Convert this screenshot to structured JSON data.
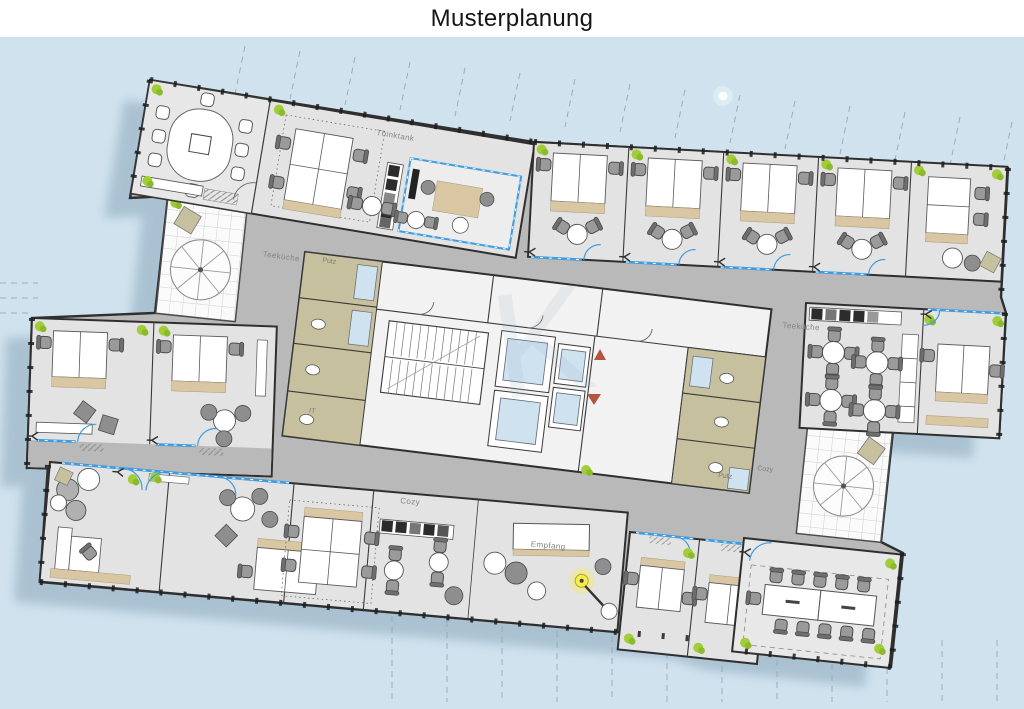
{
  "title": "Musterplanung",
  "labels": {
    "thinktank": "Thinktank",
    "teekueche_left": "Teeküche",
    "putz_left": "Putz",
    "it_room": "IT",
    "teekueche_right": "Teeküche",
    "putz_right": "Putz",
    "cozy_right": "Cozy",
    "cozy_bottom": "Cozy",
    "empfang": "Empfang"
  },
  "icons": {
    "parasol": "sun-umbrella-icon",
    "plant": "plant-icon",
    "lamp": "floor-lamp-icon",
    "elevator_up": "triangle-up-marker",
    "elevator_down": "triangle-down-marker"
  },
  "colors": {
    "ink": "#151515",
    "bg": "#cfe2ee",
    "shadow": "#8da7ba",
    "corridor": "#b9b9b9",
    "room": "#e3e3e3",
    "wall": "#2f2f2f",
    "service": "#c6c09f",
    "elev": "#cfe2f0",
    "glass": "#3f9ce0",
    "plant": "#a2cc38",
    "tan": "#d9c7a3",
    "marker": "#b2563f",
    "hl": "#f5ec4d"
  }
}
